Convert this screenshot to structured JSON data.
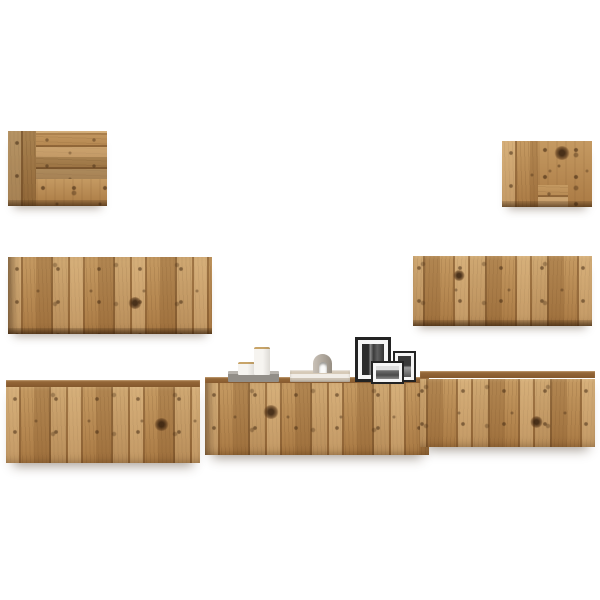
{
  "page": {
    "background": "#ffffff",
    "description": "Product photo: seven-piece wall-mounted TV cabinet set in rustic reclaimed old-wood finish on a white background, decorated with two white candles on a grey book, a stack of books with an arched stone ornament, and three black picture frames with black-and-white photos"
  },
  "palette": {
    "bg": "#ffffff",
    "wood-base": "#b5854c",
    "wood-light": "#c59a62",
    "wood-dark2": "#aa7a44",
    "slab-top": "#b8b4ae",
    "slab-front": "#928e88",
    "candle-rim": "#c8a468",
    "candle-body": "#f6f4f0",
    "book1": "#d6cab8",
    "book2": "#f1ede7",
    "book3": "#cfc5b6",
    "arch-light": "#c9c1b7",
    "arch-dark": "#968e83",
    "frame-border": "#232323",
    "mat": "#f6f6f6"
  },
  "scene": {
    "cabinets": [
      {
        "id": "cab-tl",
        "name": "small wall cabinet, upper left",
        "finish": "old wood patchwork"
      },
      {
        "id": "cab-tr",
        "name": "small wall cabinet, upper right",
        "finish": "old wood patchwork"
      },
      {
        "id": "cab-ml",
        "name": "wide wall cabinet, middle left",
        "finish": "old wood vertical planks"
      },
      {
        "id": "cab-mr",
        "name": "wide wall cabinet, middle right",
        "finish": "old wood vertical planks"
      },
      {
        "id": "cab-bl",
        "name": "TV bench unit, bottom left",
        "finish": "old wood vertical planks"
      },
      {
        "id": "cab-bc",
        "name": "TV bench unit, bottom center",
        "finish": "old wood vertical planks"
      },
      {
        "id": "cab-br",
        "name": "TV bench unit, bottom right",
        "finish": "old wood vertical planks"
      }
    ],
    "decor": [
      {
        "id": "slab",
        "name": "grey book under candles"
      },
      {
        "id": "candle-short",
        "name": "short white candle jar"
      },
      {
        "id": "candle-tall",
        "name": "tall white candle jar"
      },
      {
        "id": "books",
        "name": "stack of books"
      },
      {
        "id": "arch",
        "name": "arched stone ornament"
      },
      {
        "id": "frame-large",
        "name": "large black photo frame"
      },
      {
        "id": "frame-med",
        "name": "medium black photo frame"
      },
      {
        "id": "frame-small",
        "name": "small black photo frame"
      }
    ]
  }
}
